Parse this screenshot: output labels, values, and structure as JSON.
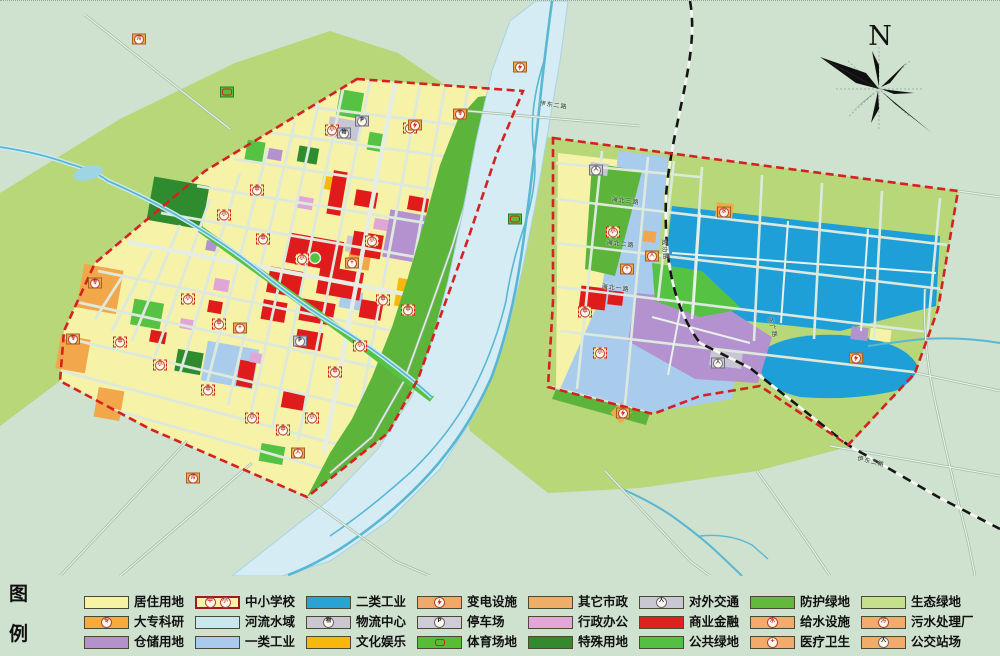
{
  "map": {
    "north_label": "N",
    "colors": {
      "background": "#cfe1cf",
      "eco_green": "#b7d778",
      "protective_green": "#5cb53a",
      "public_green": "#55c243",
      "special_green": "#2e8c2e",
      "residential": "#f6f2a8",
      "commercial_red": "#e01b1b",
      "industry2_blue": "#1f9fd8",
      "industry1_blue": "#a9cbec",
      "warehouse_purple": "#b492cf",
      "admin_pink": "#e0a6d8",
      "culture_amber": "#f8b70f",
      "utility_orange": "#f3a74b",
      "transport_gray": "#c9c6d3",
      "river": "#d6ecf5",
      "river_channel": "#58b7d2",
      "boundary_red": "#d42222",
      "railway_black": "#151515"
    },
    "road_labels": [
      {
        "t": "伊东二路",
        "x": 540,
        "y": 100,
        "r": 8
      },
      {
        "t": "伊东二路",
        "x": 858,
        "y": 455,
        "r": 14
      },
      {
        "t": "海北三路",
        "x": 612,
        "y": 196,
        "r": 7
      },
      {
        "t": "海北二路",
        "x": 607,
        "y": 239,
        "r": 7
      },
      {
        "t": "海北一路",
        "x": 602,
        "y": 283,
        "r": 7
      },
      {
        "t": "成功路",
        "x": 666,
        "y": 238,
        "r": 85
      },
      {
        "t": "东广路",
        "x": 772,
        "y": 316,
        "r": 75
      }
    ],
    "markers": [
      {
        "k": "school",
        "g": "小",
        "x": 188,
        "y": 298
      },
      {
        "k": "school",
        "g": "中",
        "x": 219,
        "y": 323
      },
      {
        "k": "school",
        "g": "中",
        "x": 120,
        "y": 341
      },
      {
        "k": "school",
        "g": "小",
        "x": 160,
        "y": 364
      },
      {
        "k": "school",
        "g": "中",
        "x": 208,
        "y": 389
      },
      {
        "k": "school",
        "g": "小",
        "x": 252,
        "y": 417
      },
      {
        "k": "school",
        "g": "中",
        "x": 283,
        "y": 429
      },
      {
        "k": "school",
        "g": "小",
        "x": 312,
        "y": 417
      },
      {
        "k": "school",
        "g": "中",
        "x": 335,
        "y": 371
      },
      {
        "k": "school",
        "g": "小",
        "x": 360,
        "y": 345
      },
      {
        "k": "school",
        "g": "中",
        "x": 383,
        "y": 299
      },
      {
        "k": "school",
        "g": "小",
        "x": 302,
        "y": 258
      },
      {
        "k": "school",
        "g": "中",
        "x": 263,
        "y": 238
      },
      {
        "k": "school",
        "g": "小",
        "x": 224,
        "y": 214
      },
      {
        "k": "school",
        "g": "中",
        "x": 257,
        "y": 189
      },
      {
        "k": "school",
        "g": "小",
        "x": 332,
        "y": 129
      },
      {
        "k": "school",
        "g": "中",
        "x": 410,
        "y": 127
      },
      {
        "k": "school",
        "g": "小",
        "x": 372,
        "y": 240
      },
      {
        "k": "school",
        "g": "中",
        "x": 408,
        "y": 309
      },
      {
        "k": "school",
        "g": "小",
        "x": 613,
        "y": 231
      },
      {
        "k": "school",
        "g": "中",
        "x": 585,
        "y": 311
      },
      {
        "k": "school",
        "g": "小",
        "x": 600,
        "y": 352
      },
      {
        "k": "college",
        "g": "专",
        "x": 95,
        "y": 282
      },
      {
        "k": "college",
        "g": "专",
        "x": 73,
        "y": 338
      },
      {
        "k": "college",
        "g": "专",
        "x": 460,
        "y": 113
      },
      {
        "k": "hospital",
        "g": "+",
        "x": 240,
        "y": 327
      },
      {
        "k": "hospital",
        "g": "+",
        "x": 352,
        "y": 262
      },
      {
        "k": "hospital",
        "g": "+",
        "x": 627,
        "y": 268
      },
      {
        "k": "substation",
        "g": "",
        "x": 415,
        "y": 124
      },
      {
        "k": "substation",
        "g": "",
        "x": 520,
        "y": 66
      },
      {
        "k": "substation",
        "g": "",
        "x": 623,
        "y": 412
      },
      {
        "k": "substation",
        "g": "",
        "x": 856,
        "y": 357
      },
      {
        "k": "water",
        "g": "水",
        "x": 724,
        "y": 211
      },
      {
        "k": "sewage",
        "g": "污",
        "x": 193,
        "y": 477
      },
      {
        "k": "sewage",
        "g": "污",
        "x": 139,
        "y": 38
      },
      {
        "k": "parking",
        "g": "P",
        "x": 362,
        "y": 120
      },
      {
        "k": "parking",
        "g": "P",
        "x": 300,
        "y": 340
      },
      {
        "k": "logistics",
        "g": "物",
        "x": 344,
        "y": 132
      },
      {
        "k": "transport",
        "g": "人",
        "x": 718,
        "y": 362
      },
      {
        "k": "transport",
        "g": "人",
        "x": 596,
        "y": 169
      },
      {
        "k": "bus",
        "g": "人",
        "x": 652,
        "y": 255
      },
      {
        "k": "bus",
        "g": "人",
        "x": 298,
        "y": 452
      },
      {
        "k": "sports",
        "g": "",
        "x": 515,
        "y": 218
      },
      {
        "k": "sports",
        "g": "",
        "x": 227,
        "y": 91
      }
    ]
  },
  "legend": {
    "title_char_1": "图",
    "title_char_2": "例",
    "columns": [
      [
        {
          "label": "居住用地",
          "fill": "#f7f3a6"
        },
        {
          "label": "大专科研",
          "fill": "#f7aa3d",
          "dots": true,
          "icon": "专"
        },
        {
          "label": "仓储用地",
          "fill": "#b392cc"
        }
      ],
      [
        {
          "label": "中小学校",
          "fill": "#f7f3a6",
          "border": "#9b1c1c",
          "borderWidth": 2,
          "icon2": [
            "中",
            "小"
          ]
        },
        {
          "label": "河流水域",
          "fill": "#c9e7ef",
          "waves": true
        },
        {
          "label": "一类工业",
          "fill": "#a9c9ee"
        }
      ],
      [
        {
          "label": "二类工业",
          "fill": "#2aa2d3"
        },
        {
          "label": "物流中心",
          "fill": "#cac7d3",
          "icon": "物",
          "iconDark": true
        },
        {
          "label": "文化娱乐",
          "fill": "#f8b70f"
        }
      ],
      [
        {
          "label": "变电设施",
          "fill": "#f2a869",
          "dots": true,
          "bolt": true
        },
        {
          "label": "停车场",
          "fill": "#cfccd8",
          "icon": "P",
          "iconDark": true
        },
        {
          "label": "体育场地",
          "fill": "#56bd35",
          "stadium": true
        }
      ],
      [
        {
          "label": "其它市政",
          "fill": "#eeae67",
          "dots": true
        },
        {
          "label": "行政办公",
          "fill": "#e2a7d8"
        },
        {
          "label": "特殊用地",
          "fill": "#338a2e"
        }
      ],
      [
        {
          "label": "对外交通",
          "fill": "#cac7d5",
          "icon": "人",
          "iconDark": true
        },
        {
          "label": "商业金融",
          "fill": "#e22020"
        },
        {
          "label": "公共绿地",
          "fill": "#53c044"
        }
      ],
      [
        {
          "label": "防护绿地",
          "fill": "#63ba3a"
        },
        {
          "label": "给水设施",
          "fill": "#f2ab6b",
          "dots": true,
          "icon": "水"
        },
        {
          "label": "医疗卫生",
          "fill": "#f2ab6b",
          "dots": true,
          "icon": "+"
        }
      ],
      [
        {
          "label": "生态绿地",
          "fill": "#c5df8e"
        },
        {
          "label": "污水处理厂",
          "fill": "#f2ab6b",
          "dots": true,
          "icon": "污"
        },
        {
          "label": "公交站场",
          "fill": "#f2ab6b",
          "dots": true,
          "icon": "人",
          "iconDark": true
        }
      ]
    ]
  }
}
